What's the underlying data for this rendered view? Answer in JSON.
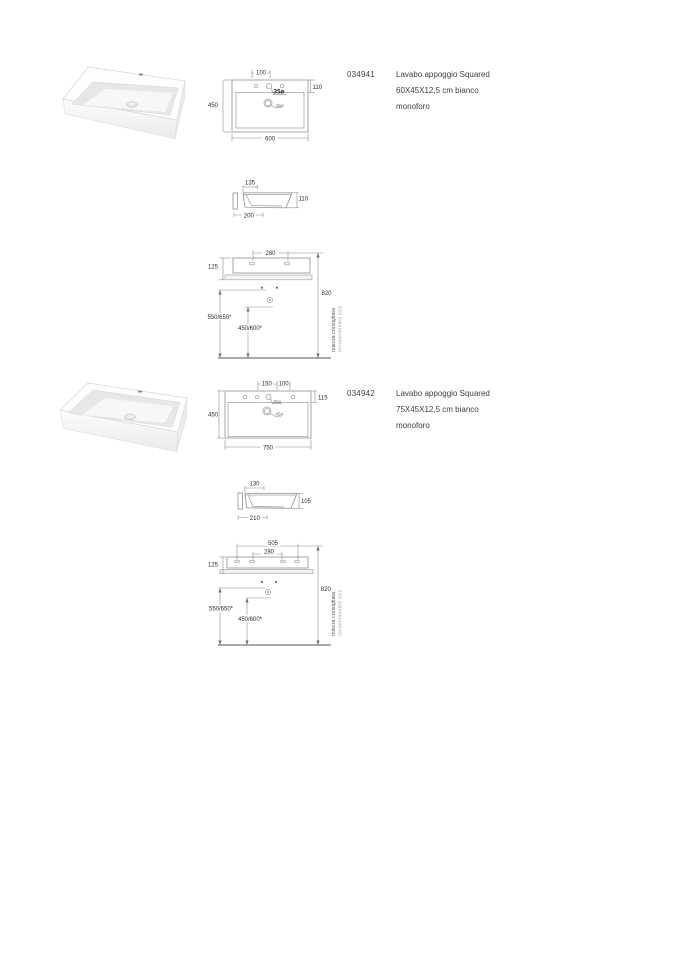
{
  "products": [
    {
      "code": "034941",
      "description": [
        "Lavabo appoggio Squared",
        "60X45X12,5 cm bianco",
        "monoforo"
      ],
      "top_view": {
        "faucet_offset": "100",
        "rim_depth": "110",
        "depth": "450",
        "width": "600",
        "faucet_hole": "35ø",
        "drain": "45ø"
      },
      "side_view": {
        "basin_inset": "135",
        "height": "110",
        "wall_ledge": "200"
      },
      "installation": {
        "hole_spacing": "280",
        "body_height": "125",
        "overall_height": "820",
        "rim_height": "550/650*",
        "drain_height": "450/600*",
        "note_primary": "misura consigliata",
        "note_secondary": "recommended size"
      }
    },
    {
      "code": "034942",
      "description": [
        "Lavabo appoggio Squared",
        "75X45X12,5 cm bianco",
        "monoforo"
      ],
      "top_view": {
        "outer_hole_offset": "150",
        "faucet_offset": "100",
        "rim_depth": "115",
        "depth": "450",
        "width": "750",
        "faucet_hole": "35ø",
        "drain": "45ø"
      },
      "side_view": {
        "basin_inset": "130",
        "height": "105",
        "wall_ledge": "210"
      },
      "installation": {
        "outer_hole_spacing": "505",
        "hole_spacing": "280",
        "body_height": "125",
        "overall_height": "820",
        "rim_height": "550/650*",
        "drain_height": "450/600*",
        "note_primary": "misura consigliata",
        "note_secondary": "recommended size"
      }
    }
  ]
}
